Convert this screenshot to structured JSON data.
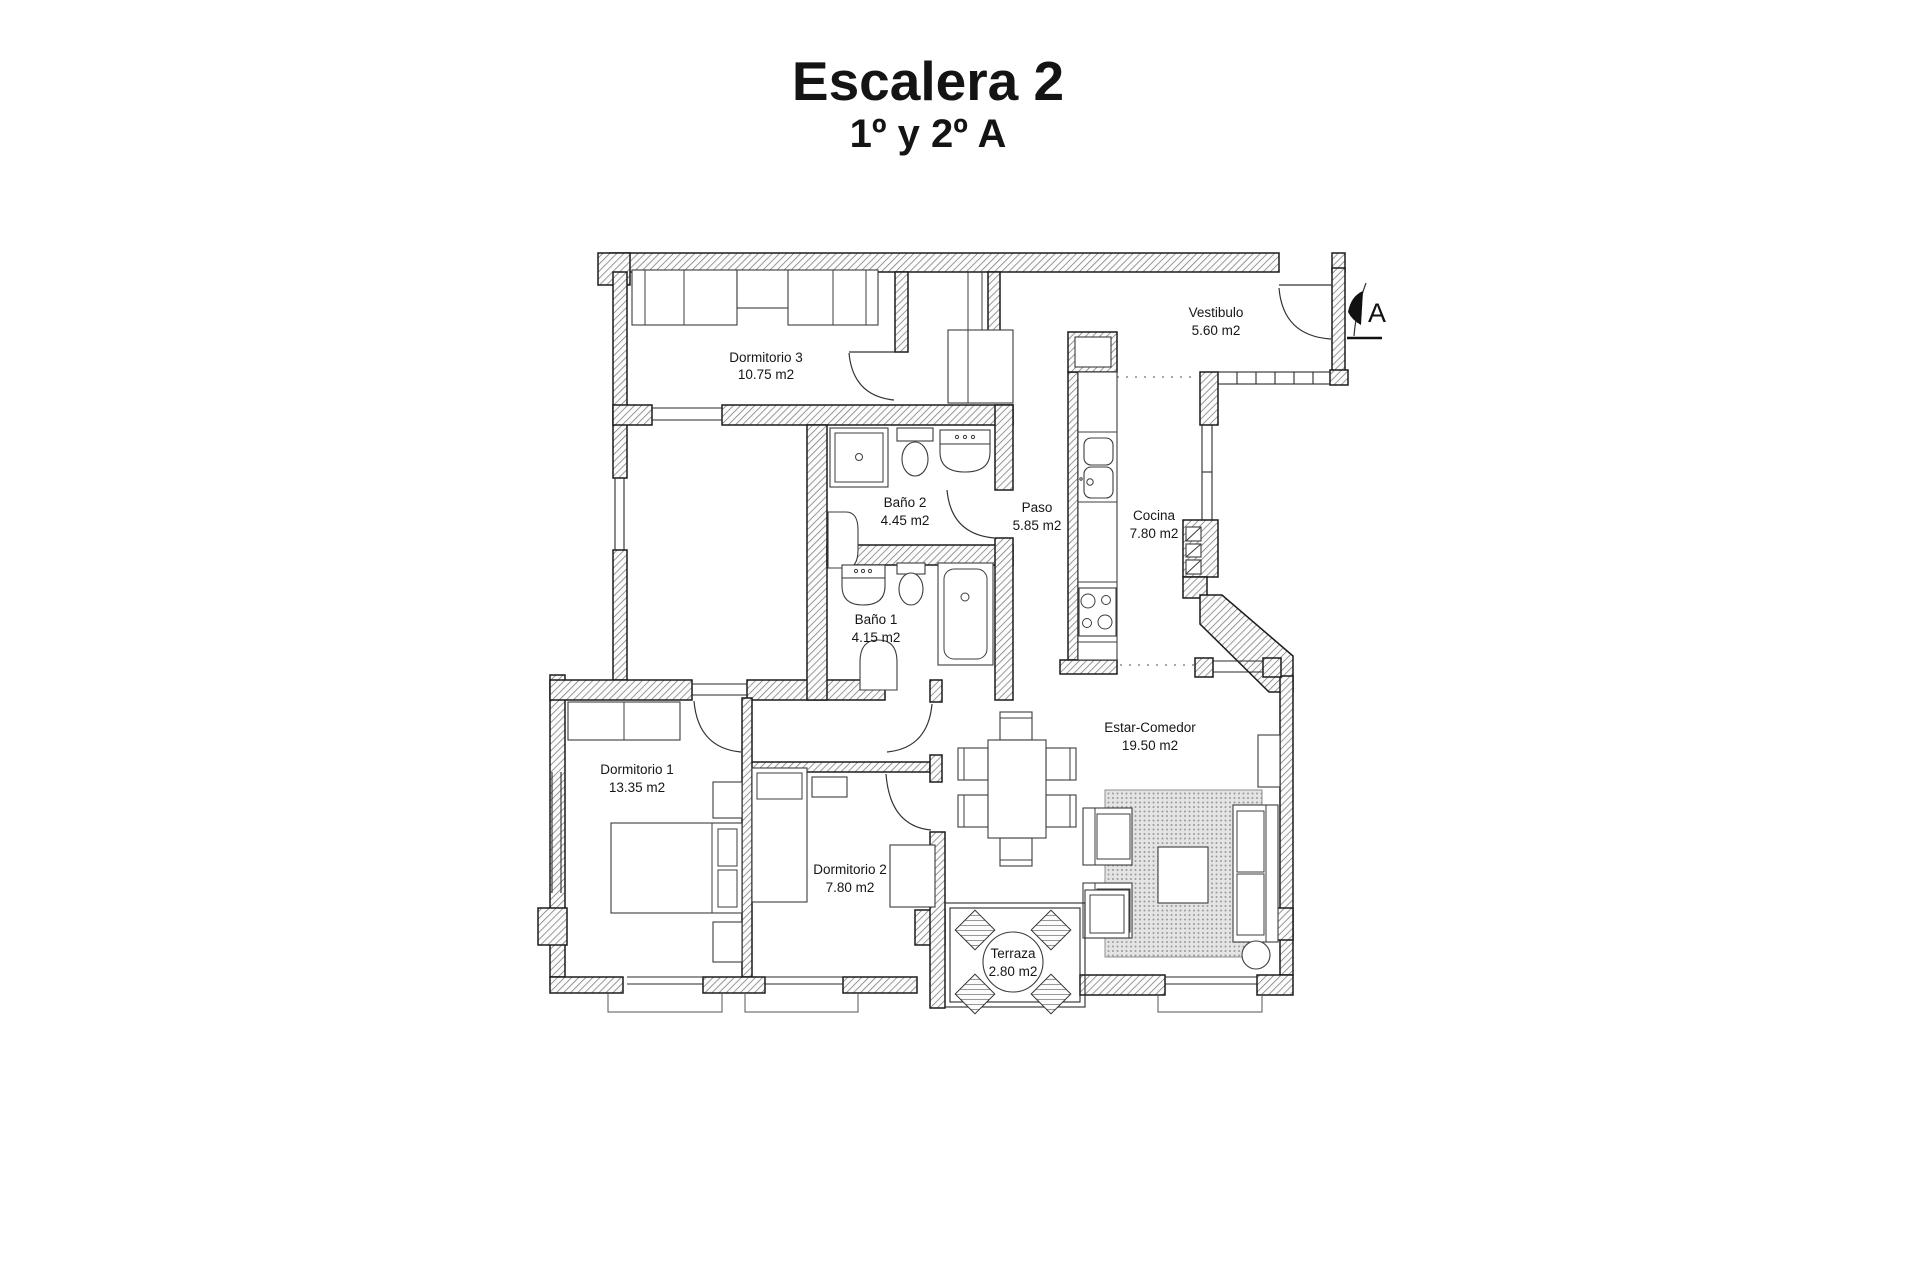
{
  "title": "Escalera 2",
  "subtitle": "1º y 2º A",
  "entrance_marker": "A",
  "rooms": {
    "dormitorio3": {
      "name": "Dormitorio 3",
      "area": "10.75 m2"
    },
    "vestibulo": {
      "name": "Vestibulo",
      "area": "5.60 m2"
    },
    "bano2": {
      "name": "Baño 2",
      "area": "4.45 m2"
    },
    "paso": {
      "name": "Paso",
      "area": "5.85 m2"
    },
    "cocina": {
      "name": "Cocina",
      "area": "7.80 m2"
    },
    "bano1": {
      "name": "Baño 1",
      "area": "4.15 m2"
    },
    "dormitorio1": {
      "name": "Dormitorio 1",
      "area": "13.35 m2"
    },
    "dormitorio2": {
      "name": "Dormitorio 2",
      "area": "7.80 m2"
    },
    "estar_comedor": {
      "name": "Estar-Comedor",
      "area": "19.50 m2"
    },
    "terraza": {
      "name": "Terraza",
      "area": "2.80 m2"
    }
  },
  "colors": {
    "wall_line": "#1b1b1b",
    "hatch": "#777777",
    "text": "#161616",
    "rug_dot": "#9a9a9a"
  }
}
